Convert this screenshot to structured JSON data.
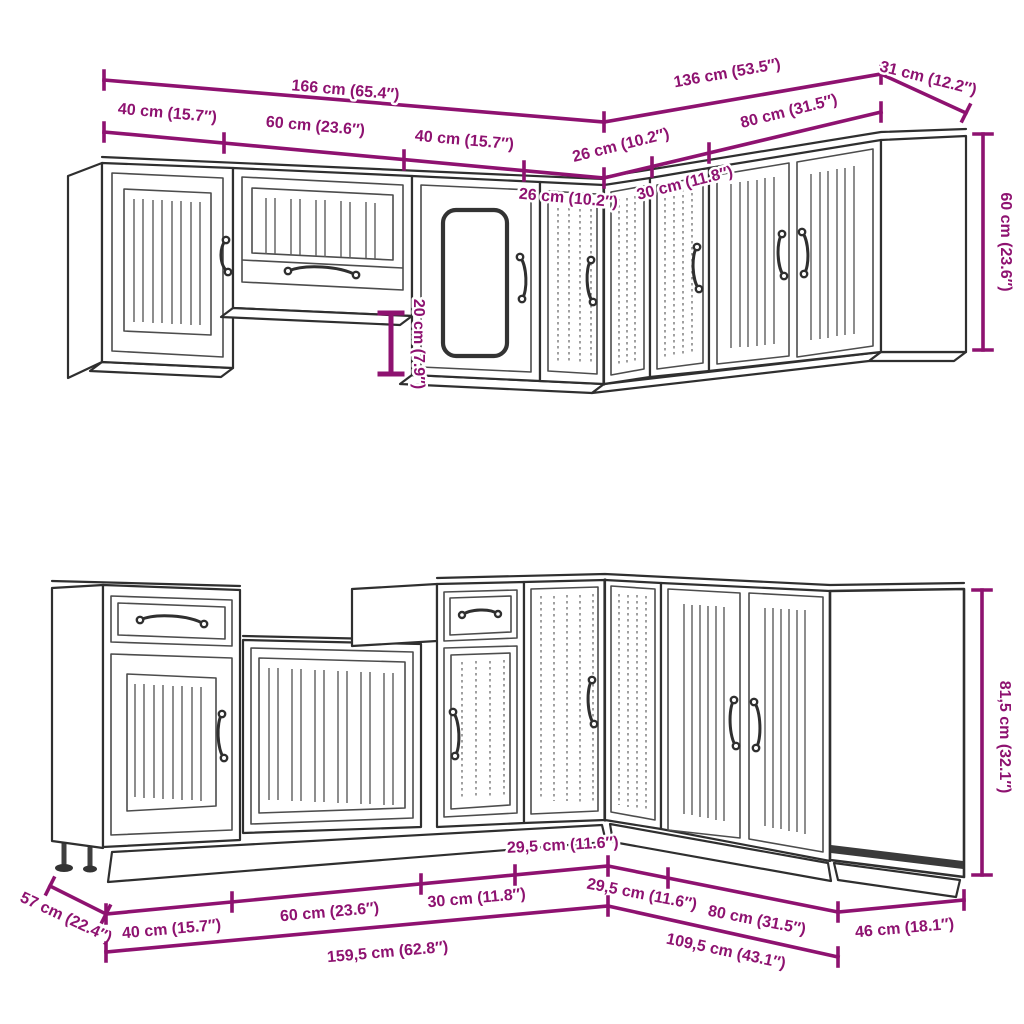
{
  "diagram": {
    "type": "kitchen-cabinet-set-dimension-drawing",
    "colors": {
      "dimension": "#8e1270",
      "outline": "#2f2f2f",
      "background": "#ffffff",
      "toe_kick": "#3a3a3a"
    },
    "wall_view": {
      "dims": {
        "total_left": "166 cm (65.4″)",
        "total_right": "136 cm (53.5″)",
        "side_depth": "31 cm (12.2″)",
        "seg_40_a": "40 cm (15.7″)",
        "seg_60": "60 cm (23.6″)",
        "seg_40_b": "40 cm (15.7″)",
        "seg_26_left": "26 cm (10.2″)",
        "seg_26_right": "26 cm (10.2″)",
        "seg_30": "30 cm (11.8″)",
        "seg_80": "80 cm (31.5″)",
        "height": "60 cm (23.6″)",
        "bridge_drop": "20 cm (7.9″)"
      }
    },
    "base_view": {
      "dims": {
        "side_depth": "57 cm (22.4″)",
        "seg_40": "40 cm (15.7″)",
        "seg_60": "60 cm (23.6″)",
        "seg_30": "30 cm (11.8″)",
        "seg_295_left": "29,5 cm (11.6″)",
        "seg_295_right": "29,5 cm (11.6″)",
        "seg_80": "80 cm (31.5″)",
        "end_depth": "46 cm (18.1″)",
        "total_left": "159,5 cm (62.8″)",
        "total_right": "109,5 cm (43.1″)",
        "height": "81,5 cm (32.1″)"
      }
    }
  }
}
